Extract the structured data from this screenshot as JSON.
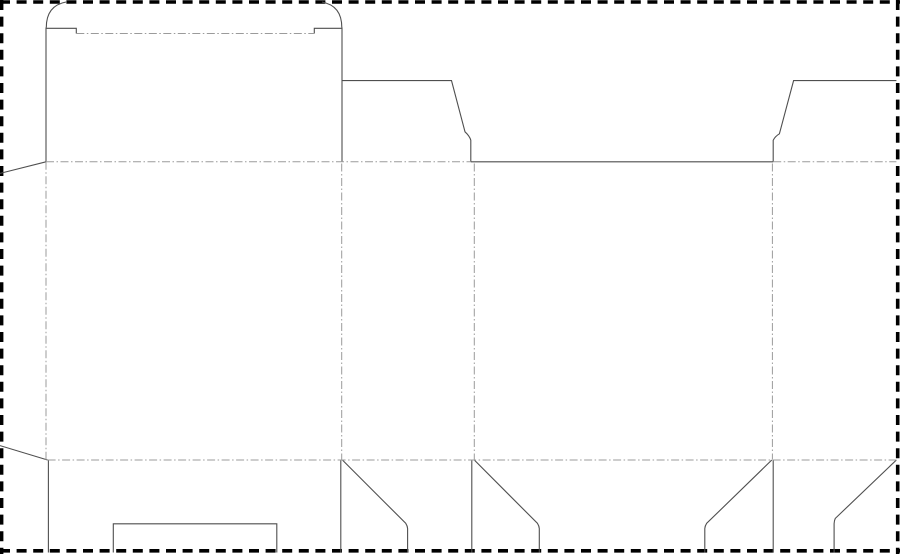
{
  "meta": {
    "description": "Die-cut packaging dieline template for a tuck-top folding carton",
    "canvas_width": 900,
    "canvas_height": 554,
    "background_color": "#ffffff"
  },
  "styles": {
    "border": {
      "stroke": "#000000",
      "width": 3.6,
      "dasharray": "10 6.6"
    },
    "cut": {
      "stroke": "#4f4f4f",
      "width": 1.1,
      "dasharray": ""
    },
    "fold": {
      "stroke": "#9b9b9b",
      "width": 1,
      "dasharray": "8 2.5 1.5 2.5"
    }
  },
  "paths": [
    {
      "name": "sheet-border-top",
      "type": "border",
      "d": "M0,2 H900"
    },
    {
      "name": "sheet-border-right",
      "type": "border",
      "d": "M897.7,0 V554"
    },
    {
      "name": "sheet-border-bottom",
      "type": "border",
      "d": "M0,550.8 H900"
    },
    {
      "name": "sheet-border-left",
      "type": "border",
      "d": "M1.6,0 V554"
    },
    {
      "name": "tuck-flap-left-corner-arc",
      "type": "cut",
      "d": "M46.3,27.5 C46.3,13 52.5,4.5 66,2"
    },
    {
      "name": "tuck-flap-right-corner-arc",
      "type": "cut",
      "d": "M341.8,27.5 C341.8,13 335.5,4.5 322,2"
    },
    {
      "name": "lid-shoulder-left-cut",
      "type": "cut",
      "d": "M46,28.3 H76.3 V33.5"
    },
    {
      "name": "lid-shoulder-right-cut",
      "type": "cut",
      "d": "M342,28.3 H314.3 V33.5"
    },
    {
      "name": "lid-side-left-cut",
      "type": "cut",
      "d": "M46,27.5 V161.8"
    },
    {
      "name": "lid-side-right-cut",
      "type": "cut",
      "d": "M342,27.5 V161.8"
    },
    {
      "name": "dust-flap-top-left-cut",
      "type": "cut",
      "d": "M342,80.6 H451.5 L465,131.8 Q469.6,136 470.8,140.2 V161.8"
    },
    {
      "name": "front-panel-top-edge-cut",
      "type": "cut",
      "d": "M470.8,161.8 H773.2"
    },
    {
      "name": "dust-flap-top-right-cut",
      "type": "cut",
      "d": "M896.4,80.6 H793.6 L779.4,133.8 Q775.3,136.2 773.2,140.2 V161.8"
    },
    {
      "name": "glue-flap-top-edge-cut",
      "type": "cut",
      "d": "M0,173.4 L46,161.8"
    },
    {
      "name": "glue-flap-bottom-edge-cut",
      "type": "cut",
      "d": "M0,445.6 L47.6,460"
    },
    {
      "name": "bottom-main-flap-left-cut",
      "type": "cut",
      "d": "M48.4,460 V552.5"
    },
    {
      "name": "bottom-lock-notch-cut",
      "type": "cut",
      "d": "M113.3,552.5 V523.8 H276.8 V552.5"
    },
    {
      "name": "bottom-main-flap-right-cut",
      "type": "cut",
      "d": "M340.8,459.8 V552.5"
    },
    {
      "name": "bottom-flap-a-diagonal-cut",
      "type": "cut",
      "d": "M342.4,460 L405.8,523.4 Q407.4,525.8 407.6,528.6 V552.5"
    },
    {
      "name": "bottom-flap-b-left-cut",
      "type": "cut",
      "d": "M471.8,460 V552.5"
    },
    {
      "name": "bottom-flap-b-diagonal-cut",
      "type": "cut",
      "d": "M474.3,460 L537.5,523.4 Q539.1,525.8 539.3,528.6 V552.5"
    },
    {
      "name": "bottom-flap-c-diagonal-cut",
      "type": "cut",
      "d": "M771.8,460 L706.6,523.4 Q705,525.8 704.8,528.6 V552.5"
    },
    {
      "name": "bottom-flap-c-right-cut",
      "type": "cut",
      "d": "M773.2,460 V552.5"
    },
    {
      "name": "bottom-flap-d-diagonal-cut",
      "type": "cut",
      "d": "M896.4,460 L835.3,518.4 Q834.2,520.8 834.1,523.6 V552.5"
    },
    {
      "name": "tuck-flap-crease-fold",
      "type": "fold",
      "d": "M76.3,33.5 H314.3"
    },
    {
      "name": "top-crease-left-fold",
      "type": "fold",
      "d": "M46,161.8 H470.8"
    },
    {
      "name": "top-crease-right-fold",
      "type": "fold",
      "d": "M773.2,161.8 H896.4"
    },
    {
      "name": "bottom-crease-fold",
      "type": "fold",
      "d": "M47.6,460 H896.4"
    },
    {
      "name": "glue-flap-crease-fold",
      "type": "fold",
      "d": "M46,161.8 V460"
    },
    {
      "name": "panel-crease-1-fold",
      "type": "fold",
      "d": "M341.7,163.5 V459.5"
    },
    {
      "name": "panel-crease-2-fold",
      "type": "fold",
      "d": "M474.3,163.5 V459.5"
    },
    {
      "name": "panel-crease-3-fold",
      "type": "fold",
      "d": "M772.4,163.5 V459.5"
    }
  ]
}
